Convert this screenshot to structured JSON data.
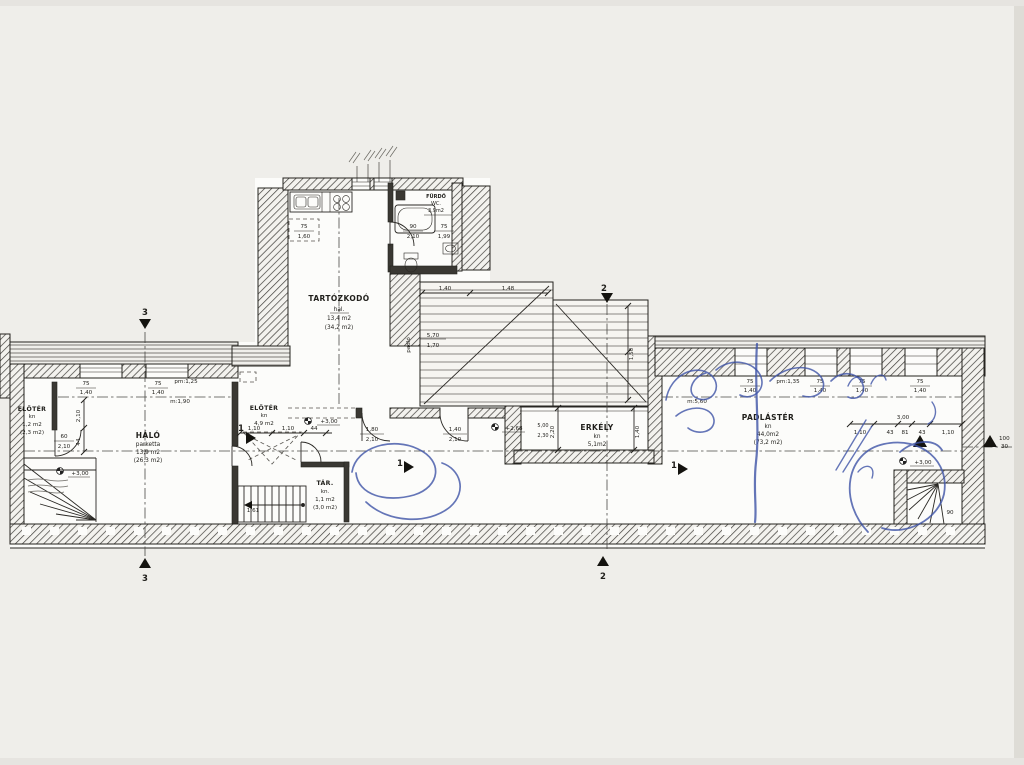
{
  "rooms": {
    "tartozkodo": {
      "name": "TARTÓZKODÓ",
      "sub": "hal.",
      "area": "13,4 m2",
      "gross": "(34,2 m2)"
    },
    "furdo": {
      "name": "FÜRDŐ",
      "sub": "WC.",
      "area": "3,9m2"
    },
    "halo": {
      "name": "HÁLÓ",
      "sub": "parketta",
      "area": "13,9 m2",
      "gross": "(26,3 m2)"
    },
    "eloter_kis": {
      "name": "ELŐTÉR",
      "sub": "kn",
      "area": "1,2 m2",
      "gross": "(2,3 m2)"
    },
    "eloter": {
      "name": "ELŐTÉR",
      "sub": "kn",
      "area": "4,9 m2"
    },
    "tar": {
      "name": "TÁR.",
      "sub": "kn.",
      "area": "1,1 m2",
      "gross": "(3,0 m2)"
    },
    "erkely": {
      "name": "ERKÉLY",
      "sub": "kn",
      "area": "5,1m2"
    },
    "padlaster": {
      "name": "PADLÁSTÉR",
      "sub": "kn",
      "area": "44,0m2",
      "gross": "(73,2 m2)"
    }
  },
  "levels": {
    "plus300": "+3,00",
    "plus268": "+2,68"
  },
  "openings": {
    "window_w": "75",
    "window_h": "1,40",
    "roof_window_w": "75",
    "roof_window_h": "1,60",
    "bath_window_w": "75",
    "bath_window_h": "1,99",
    "door_bath_w": "90",
    "door_bath_h": "2,10",
    "door_entry_w": "60",
    "door_entry_h": "2,10",
    "door_main_w": "1,80",
    "door_main_h": "2,10",
    "door_balcony_w": "1,40",
    "door_balcony_h": "2,10",
    "door_stair_w": "90",
    "parapet_left": "pm:1,25",
    "head_left": "m:1,90",
    "parapet_right": "pm:1,35",
    "head_right": "m:5,60"
  },
  "dimensions": {
    "d140": "1,40",
    "d148": "1,48",
    "d570": "5,70",
    "d170": "1,70",
    "d220": "2,20",
    "d500": "5,00",
    "d230": "2,30",
    "d150": "1,50",
    "d110": "1,10",
    "d44": "44",
    "d210": "2,10",
    "d300": "3,00",
    "d43": "43",
    "d81": "81",
    "d161": "1,61",
    "note_padlo": "padló"
  },
  "sections": {
    "s1": "1",
    "s2": "2",
    "s3": "3"
  },
  "margin_note": {
    "top": "100",
    "bottom": "30"
  }
}
